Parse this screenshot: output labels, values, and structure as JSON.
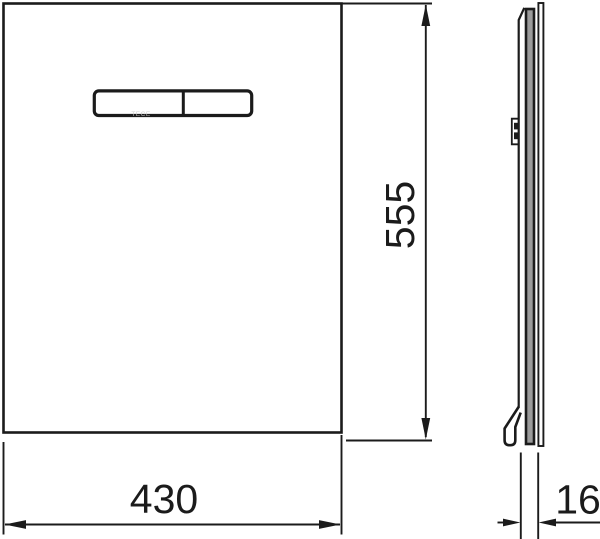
{
  "drawing": {
    "background_color": "#ffffff",
    "line_color": "#1b1b1b",
    "glass_core_color": "#9b9b9b",
    "faint_logo_color": "#c9c9c9",
    "front_view": {
      "logo_text": "TECE",
      "button_segments": 2
    },
    "dimensions": {
      "width": {
        "value": "430"
      },
      "height": {
        "value": "555"
      },
      "depth": {
        "value": "16"
      }
    }
  }
}
